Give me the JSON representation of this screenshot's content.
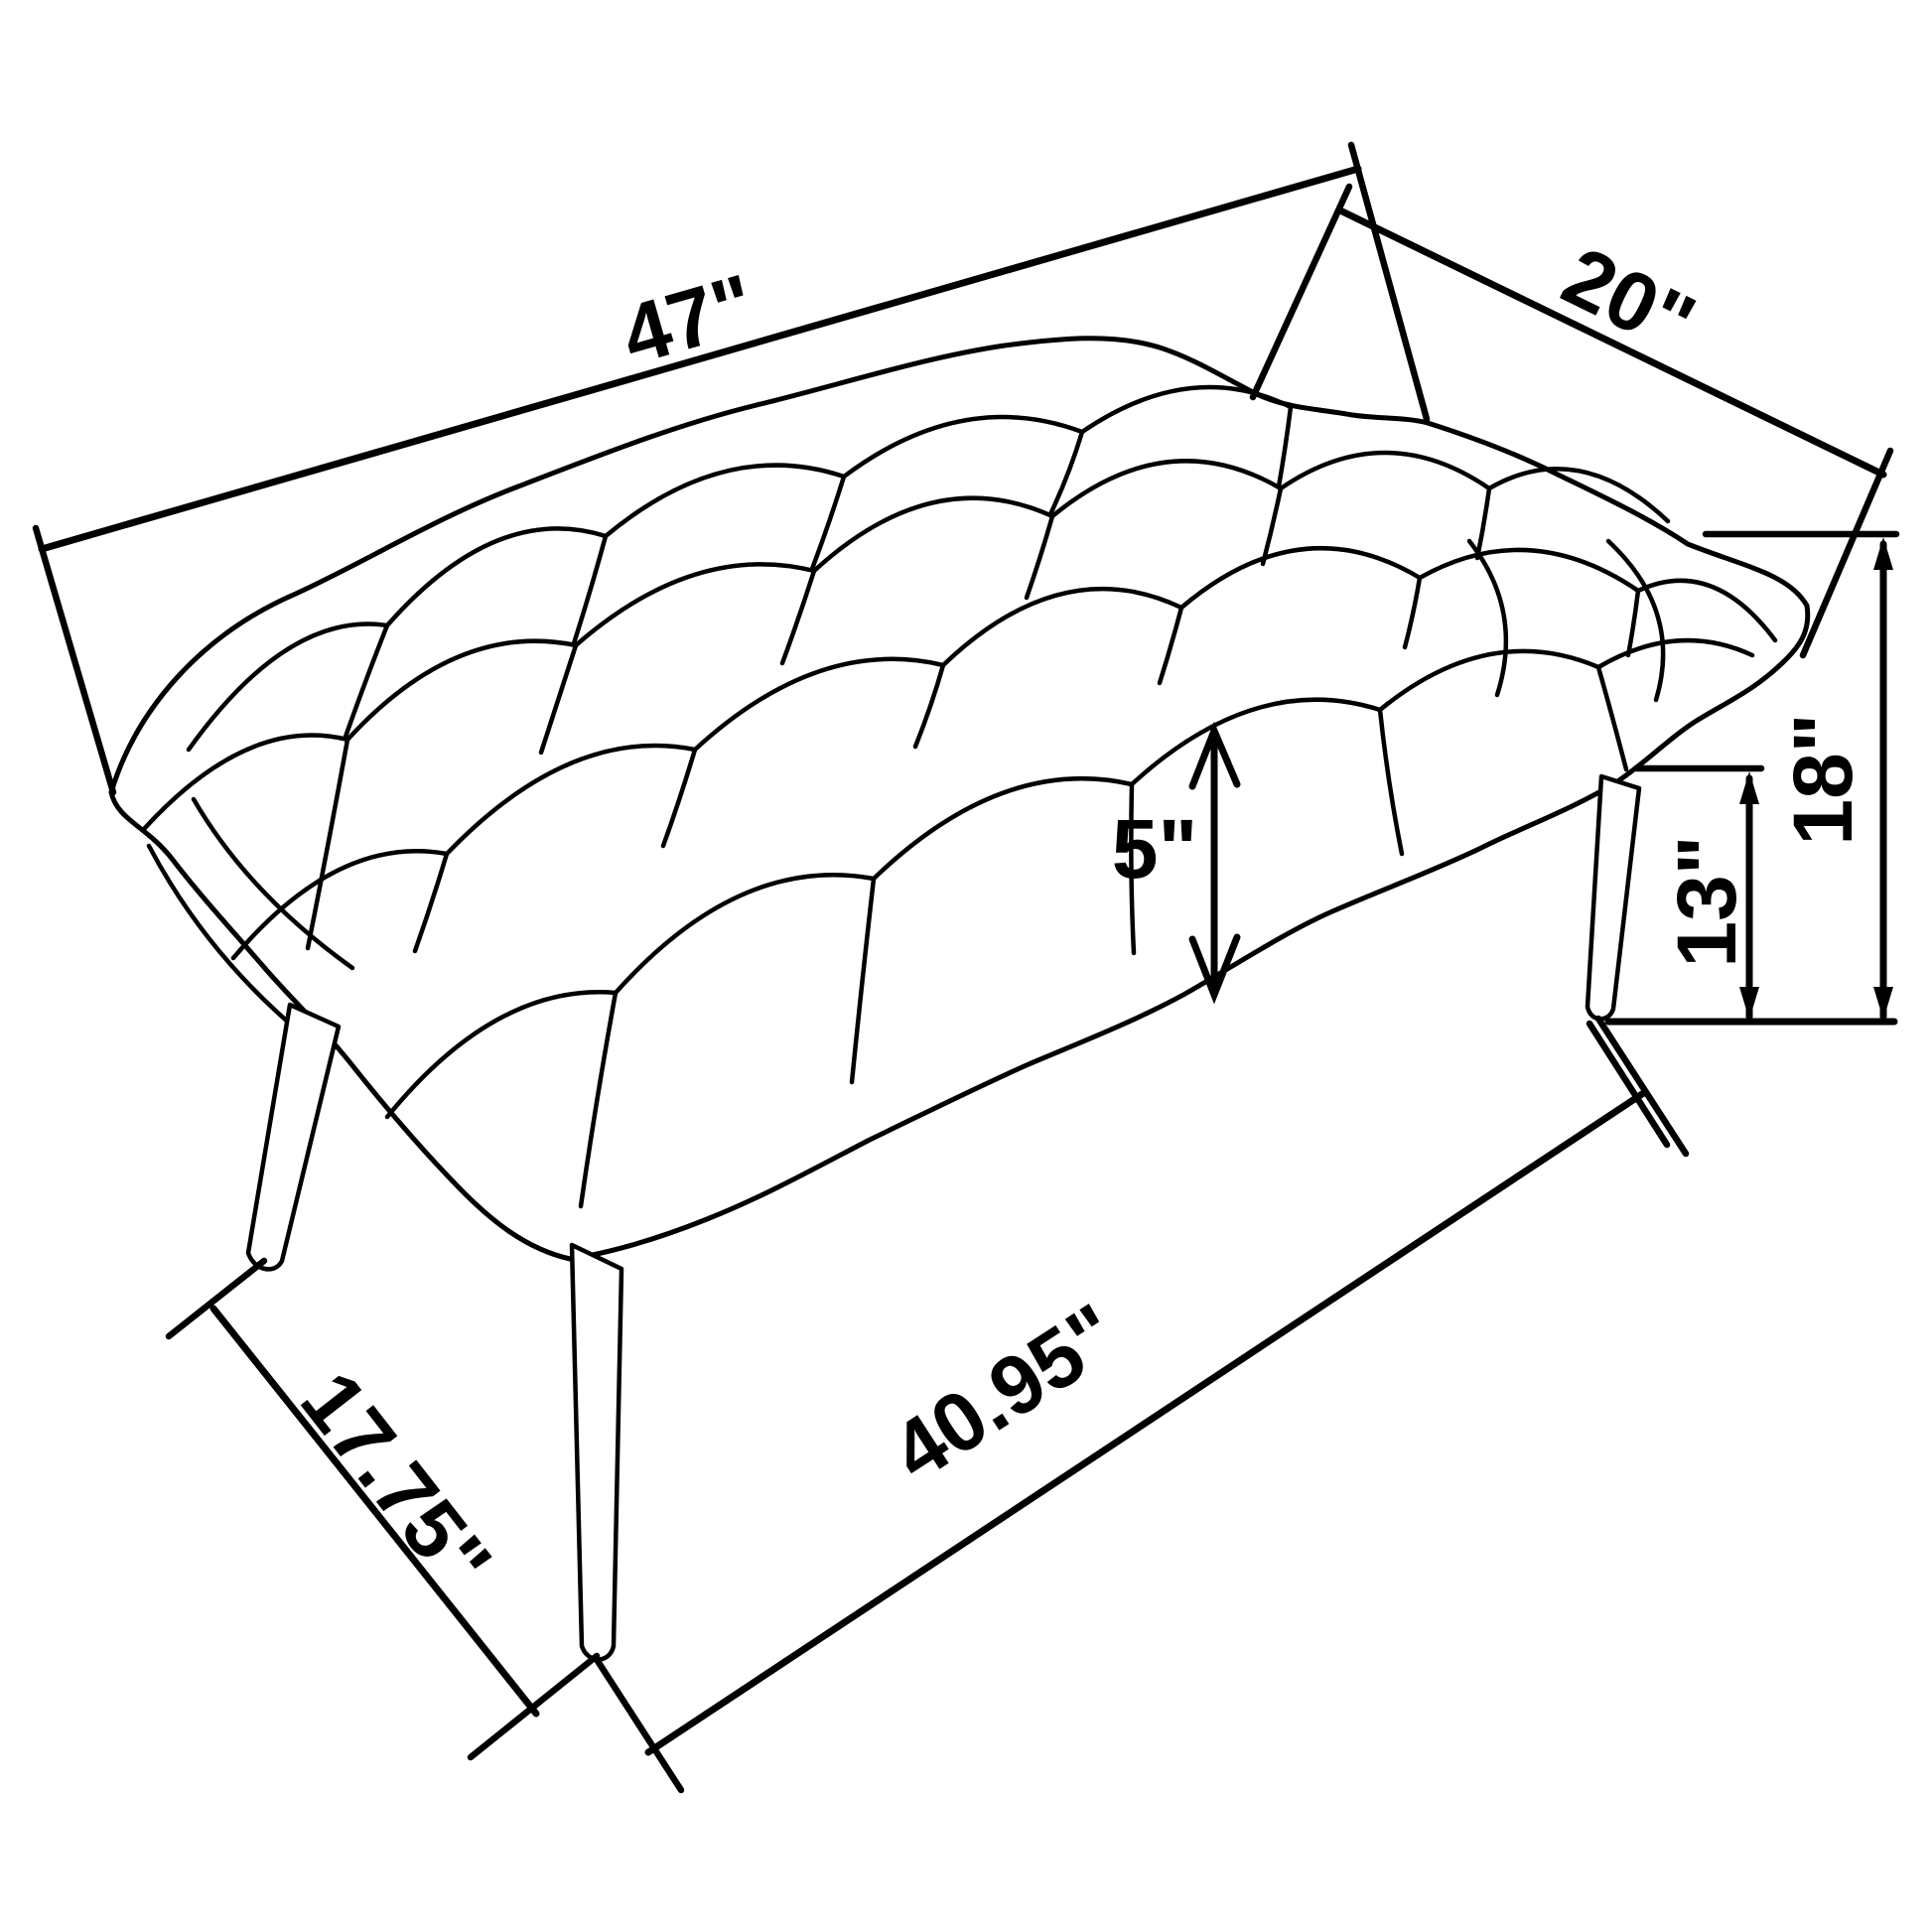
{
  "diagram": {
    "name": "tufted-bench-dimension-diagram",
    "object": "upholstered tufted bench with four splayed tapered legs",
    "unit": "inches",
    "line_color": "#000000",
    "background_color": "#ffffff",
    "labels": {
      "length_top": "47\"",
      "depth_top": "20\"",
      "overall_height": "18\"",
      "floor_to_frame": "13\"",
      "cushion_thickness": "5\"",
      "leg_span_length": "40.95\"",
      "leg_span_depth": "17.75\""
    }
  }
}
